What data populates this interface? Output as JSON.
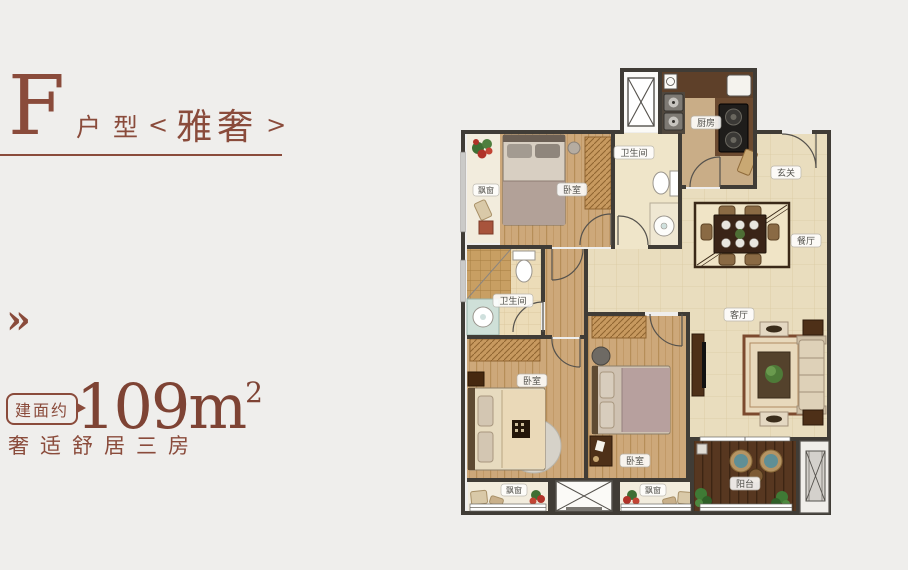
{
  "page": {
    "background": "#efeeec",
    "accent_color": "#8a4b3b"
  },
  "header": {
    "unit_letter": "F",
    "unit_type_label": "户型",
    "bracket_left": "<",
    "unit_name": "雅奢",
    "bracket_right": ">"
  },
  "marker": {
    "chevron": "»"
  },
  "area": {
    "badge": "建面约",
    "value": "109m",
    "superscript": "2",
    "tagline": "奢适舒居三房"
  },
  "floorplan": {
    "rooms": [
      {
        "id": "bay-window-top-left",
        "label": "飘窗"
      },
      {
        "id": "bedroom-1",
        "label": "卧室"
      },
      {
        "id": "bathroom-1",
        "label": "卫生间"
      },
      {
        "id": "kitchen",
        "label": "厨房"
      },
      {
        "id": "foyer",
        "label": "玄关"
      },
      {
        "id": "dining-room",
        "label": "餐厅"
      },
      {
        "id": "bathroom-2",
        "label": "卫生间"
      },
      {
        "id": "bedroom-2",
        "label": "卧室"
      },
      {
        "id": "bedroom-3",
        "label": "卧室"
      },
      {
        "id": "living-room",
        "label": "客厅"
      },
      {
        "id": "balcony",
        "label": "阳台"
      },
      {
        "id": "bay-window-bottom-left",
        "label": "飘窗"
      },
      {
        "id": "bay-window-bottom-mid",
        "label": "飘窗"
      }
    ],
    "colors": {
      "wall": "#403c36",
      "wood_floor": "#cda87a",
      "tile_floor": "#e9ddbe",
      "balcony_deck": "#573720",
      "bay_marble": "#f2ecdd"
    }
  }
}
